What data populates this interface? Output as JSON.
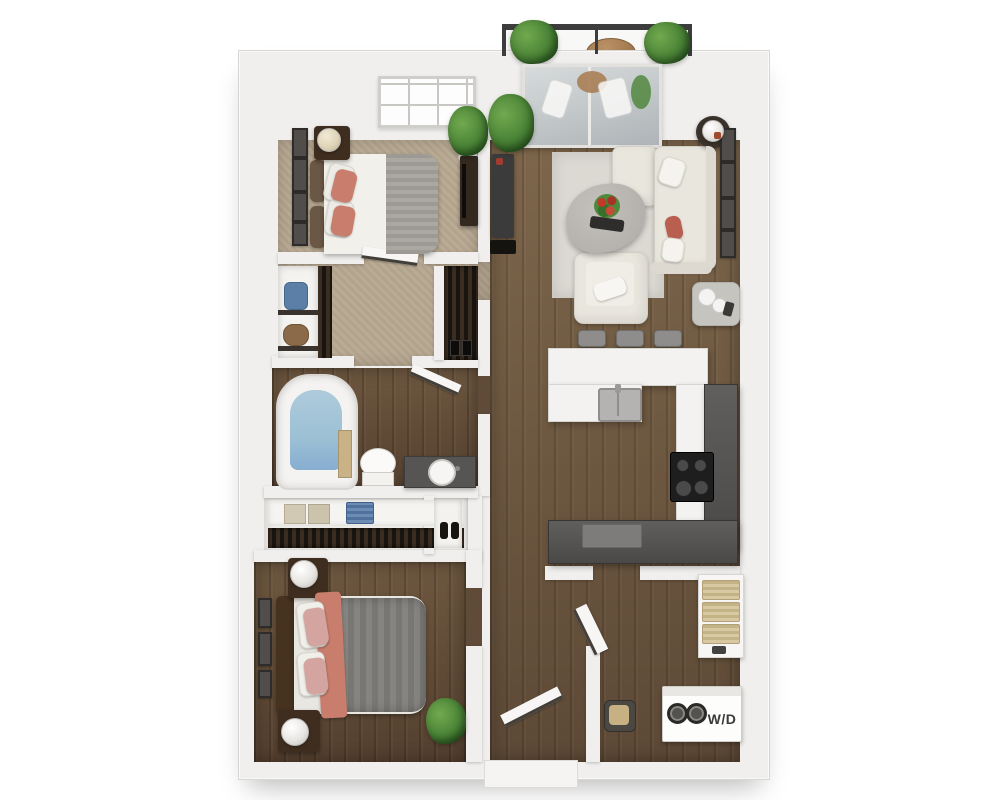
{
  "labels": {
    "washer_dryer": "W/D"
  },
  "colors": {
    "wall": "#f0efed",
    "wall_edge": "#d8d6d2",
    "wood_light": "#7d664b",
    "wood_dark": "#5d4936",
    "carpet": "#b7a891",
    "rug": "#dcd9d3",
    "sofa": "#e9e6de",
    "coral": "#c87d6d",
    "pink": "#d4a5a0",
    "blanket_gray": "#7e7d7a",
    "throw_gray": "#a7a39d",
    "counter_white": "#f3f2f0",
    "counter_dark": "#4b4947",
    "stove_black": "#1e1e1e",
    "plant_green": "#4a8336",
    "water_blue": "#9cc0d4",
    "wood_furniture": "#3f2e1f",
    "railing": "#3d3d3d",
    "frame_dark": "#3c3a38",
    "tan": "#c9b286",
    "text_dark": "#3a3a3a"
  },
  "rooms": [
    {
      "id": "balcony",
      "furniture": [
        "potted-plant",
        "potted-plant",
        "bistro-table",
        "bistro-chairs",
        "railing"
      ]
    },
    {
      "id": "living-room",
      "furniture": [
        "sectional-sofa",
        "coffee-table",
        "armchair",
        "area-rug",
        "media-console",
        "side-table-with-lamp",
        "decor-table",
        "wall-frames",
        "potted-plant",
        "sliding-glass-door"
      ]
    },
    {
      "id": "bedroom-1",
      "furniture": [
        "bed",
        "nightstand-with-lamp",
        "dresser",
        "wall-frames",
        "window",
        "potted-plant"
      ]
    },
    {
      "id": "walk-in-closet",
      "furniture": [
        "shelf-closet-with-bags",
        "hanging-clothes-closet"
      ]
    },
    {
      "id": "bathroom",
      "furniture": [
        "bathtub",
        "toilet",
        "vanity-sink",
        "door"
      ]
    },
    {
      "id": "bedroom-2",
      "furniture": [
        "bed",
        "nightstand-with-lamp",
        "nightstand-with-lamp",
        "wardrobe-closet",
        "shoe-closet",
        "wall-frames",
        "potted-plant"
      ]
    },
    {
      "id": "kitchen",
      "furniture": [
        "island-with-sink",
        "bar-stools",
        "range",
        "dark-counters",
        "white-counters"
      ]
    },
    {
      "id": "entry-laundry",
      "furniture": [
        "washer-dryer",
        "shelving-unit",
        "basket",
        "entry-door"
      ]
    }
  ]
}
